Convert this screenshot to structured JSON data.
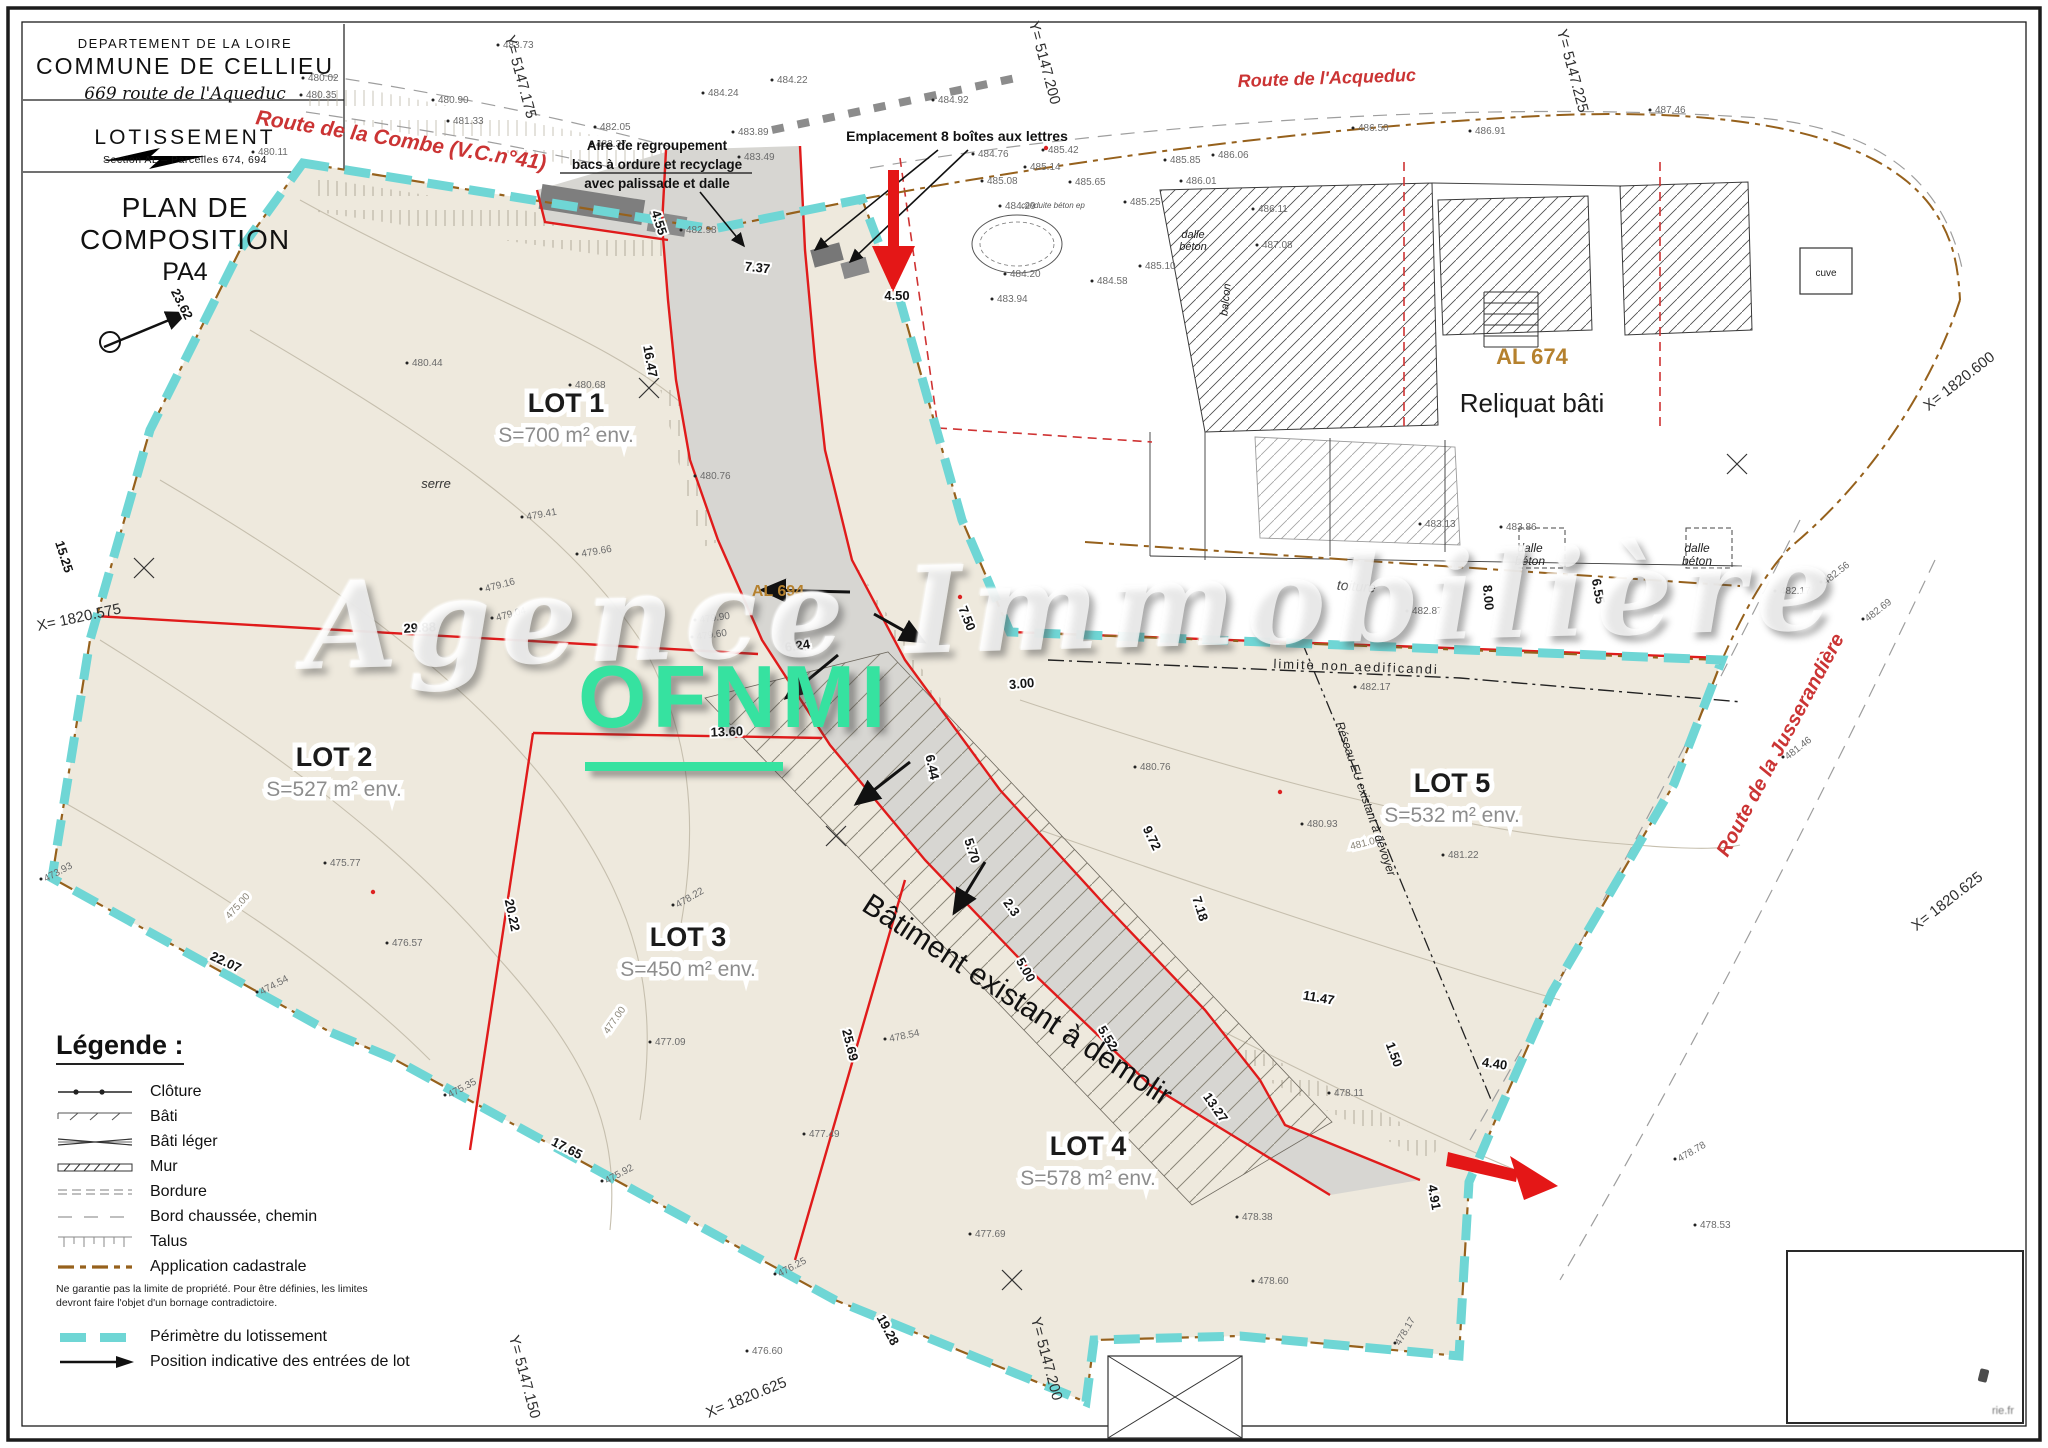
{
  "title_block": {
    "department": "DEPARTEMENT DE LA LOIRE",
    "commune": "COMMUNE DE CELLIEU",
    "address": "669 route de l'Aqueduc",
    "doc_type": "LOTISSEMENT",
    "section": "Section AL – Parcelles 674, 694",
    "plan_title": "PLAN DE COMPOSITION",
    "plan_ref": "PA4"
  },
  "watermark": {
    "script": "Agence Immobilière",
    "brand": "OFNMI"
  },
  "stamp": {
    "text": "rie.fr"
  },
  "legend": {
    "title": "Légende :",
    "items": [
      {
        "key": "cloture",
        "label": "Clôture"
      },
      {
        "key": "bati",
        "label": "Bâti"
      },
      {
        "key": "bati-leger",
        "label": "Bâti léger"
      },
      {
        "key": "mur",
        "label": "Mur"
      },
      {
        "key": "bordure",
        "label": "Bordure"
      },
      {
        "key": "bord-chaussee",
        "label": "Bord chaussée, chemin"
      },
      {
        "key": "talus",
        "label": "Talus"
      },
      {
        "key": "application-cadastrale",
        "label": "Application cadastrale"
      }
    ],
    "cadastral_note_line1": "Ne garantie pas la limite de propriété. Pour être définies, les limites",
    "cadastral_note_line2": "devront faire l'objet d'un bornage contradictoire.",
    "perimeter_label": "Périmètre du lotissement",
    "entries_label": "Position indicative des entrées de lot"
  },
  "lots": [
    {
      "name": "LOT 1",
      "area": "S=700 m² env.",
      "x": 566,
      "y": 412
    },
    {
      "name": "LOT 2",
      "area": "S=527 m² env.",
      "x": 334,
      "y": 766
    },
    {
      "name": "LOT 3",
      "area": "S=450 m² env.",
      "x": 688,
      "y": 946
    },
    {
      "name": "LOT 4",
      "area": "S=578 m² env.",
      "x": 1088,
      "y": 1155
    },
    {
      "name": "LOT 5",
      "area": "S=532 m² env.",
      "x": 1452,
      "y": 792
    }
  ],
  "map": {
    "roads": [
      {
        "t": "Route de la Combe (V.C.n°41)",
        "x": 400,
        "y": 147,
        "r": 9,
        "s": 21,
        "n": "road-label-combe"
      },
      {
        "t": "Route de l'Acqueduc",
        "x": 1327,
        "y": 84,
        "r": -2,
        "s": 18,
        "n": "road-label-acqueduc"
      },
      {
        "t": "Route de la Jusserandière",
        "x": 1786,
        "y": 748,
        "r": -62,
        "s": 20,
        "n": "road-label-jusserandiere"
      }
    ],
    "texts": [
      {
        "t": "AL 674",
        "x": 1532,
        "y": 364,
        "s": 22,
        "c": "#b5812e",
        "w": 700,
        "n": "parcel-code-al674"
      },
      {
        "t": "Reliquat bâti",
        "x": 1532,
        "y": 412,
        "s": 26,
        "c": "#1a1a1a",
        "n": "reliquat-bati-label"
      },
      {
        "t": "AL 694",
        "x": 778,
        "y": 596,
        "s": 16,
        "c": "#b5812e",
        "w": 700,
        "n": "parcel-code-al694"
      },
      {
        "t": "Bâtiment existant à démolir",
        "x": 1012,
        "y": 1008,
        "s": 30,
        "r": 33,
        "c": "#111111",
        "n": "batiment-demolir-label"
      },
      {
        "t": "serre",
        "x": 436,
        "y": 488,
        "s": 13,
        "i": 1,
        "c": "#333333",
        "n": "serre-label"
      },
      {
        "t": "toiture",
        "x": 1356,
        "y": 591,
        "s": 14,
        "i": 1,
        "r": 4,
        "c": "#444444",
        "n": "toiture-label"
      },
      {
        "t": "limite non aedificandi",
        "x": 1356,
        "y": 671,
        "s": 13,
        "r": 2,
        "sp": 2,
        "c": "#222222",
        "n": "limite-non-aedificandi-label"
      },
      {
        "t": "Réseau EU existant à dévoyer",
        "x": 1362,
        "y": 800,
        "s": 12,
        "r": 71,
        "i": 1,
        "c": "#222222",
        "n": "reseau-eu-label"
      },
      {
        "t": "dalle",
        "x": 1193,
        "y": 238,
        "s": 11,
        "i": 1,
        "c": "#222222",
        "n": "dalle-beton-label"
      },
      {
        "t": "béton",
        "x": 1193,
        "y": 250,
        "s": 11,
        "i": 1,
        "c": "#222222",
        "n": "dalle-beton-label"
      },
      {
        "t": "dalle",
        "x": 1530,
        "y": 552,
        "s": 12,
        "i": 1,
        "c": "#222222",
        "n": "dalle-beton-label"
      },
      {
        "t": "béton",
        "x": 1530,
        "y": 565,
        "s": 12,
        "i": 1,
        "c": "#222222",
        "n": "dalle-beton-label"
      },
      {
        "t": "dalle",
        "x": 1697,
        "y": 552,
        "s": 12,
        "i": 1,
        "c": "#222222",
        "n": "dalle-beton-label"
      },
      {
        "t": "béton",
        "x": 1697,
        "y": 565,
        "s": 12,
        "i": 1,
        "c": "#222222",
        "n": "dalle-beton-label"
      },
      {
        "t": "balcon",
        "x": 1229,
        "y": 300,
        "r": -84,
        "s": 11,
        "i": 1,
        "c": "#222222",
        "n": "balcon-label"
      },
      {
        "t": "conduite béton ep",
        "x": 1053,
        "y": 208,
        "s": 8,
        "i": 1,
        "c": "#555555",
        "n": "conduite-beton-label"
      },
      {
        "t": "cuve",
        "x": 1826,
        "y": 276,
        "s": 10,
        "c": "#222222",
        "n": "cuve-label"
      },
      {
        "t": "Aire de regroupement",
        "x": 657,
        "y": 150,
        "s": 13.5,
        "w": 700,
        "c": "#111111",
        "n": "callout-aire-line1"
      },
      {
        "t": "bacs à ordure et recyclage",
        "x": 657,
        "y": 169,
        "s": 13.5,
        "w": 700,
        "c": "#111111",
        "n": "callout-aire-line2"
      },
      {
        "t": "avec palissade et dalle",
        "x": 657,
        "y": 188,
        "s": 13.5,
        "w": 700,
        "c": "#111111",
        "n": "callout-aire-line3"
      },
      {
        "t": "Emplacement 8 boîtes aux lettres",
        "x": 957,
        "y": 141,
        "s": 14,
        "w": 700,
        "c": "#111111",
        "n": "callout-mailboxes"
      }
    ],
    "dimensions": [
      {
        "v": "7.37",
        "x": 757,
        "y": 272,
        "r": 6
      },
      {
        "v": "4.55",
        "x": 655,
        "y": 224,
        "r": 72
      },
      {
        "v": "4.50",
        "x": 897,
        "y": 300,
        "r": 0
      },
      {
        "v": "16.47",
        "x": 646,
        "y": 362,
        "r": 80
      },
      {
        "v": "29.88",
        "x": 420,
        "y": 632,
        "r": -3
      },
      {
        "v": "13.60",
        "x": 727,
        "y": 736,
        "r": -2
      },
      {
        "v": "23.62",
        "x": 178,
        "y": 306,
        "r": 63
      },
      {
        "v": "15.25",
        "x": 60,
        "y": 558,
        "r": 72
      },
      {
        "v": "20.22",
        "x": 508,
        "y": 916,
        "r": 78
      },
      {
        "v": "22.07",
        "x": 224,
        "y": 966,
        "r": 25
      },
      {
        "v": "17.65",
        "x": 565,
        "y": 1152,
        "r": 27
      },
      {
        "v": "25.69",
        "x": 846,
        "y": 1046,
        "r": 76
      },
      {
        "v": "19.28",
        "x": 884,
        "y": 1332,
        "r": 62
      },
      {
        "v": "7.50",
        "x": 963,
        "y": 620,
        "r": 68
      },
      {
        "v": "3.00",
        "x": 1022,
        "y": 688,
        "r": -5
      },
      {
        "v": "9.72",
        "x": 1148,
        "y": 840,
        "r": 64
      },
      {
        "v": "6.44",
        "x": 928,
        "y": 768,
        "r": 78
      },
      {
        "v": "5.70",
        "x": 968,
        "y": 852,
        "r": 72
      },
      {
        "v": "5.52",
        "x": 1104,
        "y": 1040,
        "r": 58
      },
      {
        "v": "7.18",
        "x": 1196,
        "y": 910,
        "r": 72
      },
      {
        "v": "11.47",
        "x": 1318,
        "y": 1002,
        "r": 10
      },
      {
        "v": "13.27",
        "x": 1212,
        "y": 1110,
        "r": 55
      },
      {
        "v": "4.40",
        "x": 1494,
        "y": 1068,
        "r": 8
      },
      {
        "v": "4.91",
        "x": 1430,
        "y": 1198,
        "r": 80
      },
      {
        "v": "1.50",
        "x": 1390,
        "y": 1056,
        "r": 70
      },
      {
        "v": "8.00",
        "x": 1484,
        "y": 598,
        "r": 85
      },
      {
        "v": "6.55",
        "x": 1594,
        "y": 592,
        "r": 80
      },
      {
        "v": "6.24",
        "x": 798,
        "y": 650,
        "r": -8
      },
      {
        "v": "2.3",
        "x": 1008,
        "y": 910,
        "r": 55
      },
      {
        "v": "5.00",
        "x": 1022,
        "y": 972,
        "r": 60
      }
    ],
    "coordinate_labels": [
      {
        "v": "Y= 5147.175",
        "x": 516,
        "y": 78,
        "r": 75
      },
      {
        "v": "Y= 5147.200",
        "x": 1040,
        "y": 64,
        "r": 75
      },
      {
        "v": "Y= 5147.225",
        "x": 1568,
        "y": 72,
        "r": 75
      },
      {
        "v": "X= 1820.600",
        "x": 1962,
        "y": 385,
        "r": -38
      },
      {
        "v": "X= 1820.625",
        "x": 1950,
        "y": 905,
        "r": -38
      },
      {
        "v": "X= 1820.575",
        "x": 80,
        "y": 622,
        "r": -12
      },
      {
        "v": "Y= 5147.150",
        "x": 520,
        "y": 1378,
        "r": 75
      },
      {
        "v": "X= 1820.625",
        "x": 748,
        "y": 1402,
        "r": -22
      },
      {
        "v": "Y= 5147.200",
        "x": 1042,
        "y": 1360,
        "r": 75
      }
    ],
    "contour_labels": [
      {
        "v": "475.00",
        "x": 240,
        "y": 908,
        "r": -48
      },
      {
        "v": "477.00",
        "x": 617,
        "y": 1022,
        "r": -55
      },
      {
        "v": "481.00",
        "x": 1366,
        "y": 846,
        "r": -14
      }
    ],
    "spot_elevations": [
      {
        "v": "480.02",
        "x": 308,
        "y": 81
      },
      {
        "v": "480.35",
        "x": 306,
        "y": 98
      },
      {
        "v": "480.11",
        "x": 258,
        "y": 155
      },
      {
        "v": "483.73",
        "x": 503,
        "y": 48
      },
      {
        "v": "484.22",
        "x": 777,
        "y": 83
      },
      {
        "v": "484.24",
        "x": 708,
        "y": 96
      },
      {
        "v": "483.89",
        "x": 738,
        "y": 135
      },
      {
        "v": "483.49",
        "x": 744,
        "y": 160
      },
      {
        "v": "484.92",
        "x": 938,
        "y": 103
      },
      {
        "v": "485.42",
        "x": 1048,
        "y": 153
      },
      {
        "v": "484.76",
        "x": 978,
        "y": 157
      },
      {
        "v": "485.14",
        "x": 1030,
        "y": 170
      },
      {
        "v": "485.08",
        "x": 987,
        "y": 184
      },
      {
        "v": "485.65",
        "x": 1075,
        "y": 185
      },
      {
        "v": "485.85",
        "x": 1170,
        "y": 163
      },
      {
        "v": "486.01",
        "x": 1186,
        "y": 184
      },
      {
        "v": "486.06",
        "x": 1218,
        "y": 158
      },
      {
        "v": "484.29",
        "x": 1005,
        "y": 209
      },
      {
        "v": "485.25",
        "x": 1130,
        "y": 205
      },
      {
        "v": "486.11",
        "x": 1258,
        "y": 212
      },
      {
        "v": "486.50",
        "x": 1358,
        "y": 131
      },
      {
        "v": "486.91",
        "x": 1475,
        "y": 134
      },
      {
        "v": "487.46",
        "x": 1655,
        "y": 113
      },
      {
        "v": "484.20",
        "x": 1010,
        "y": 277
      },
      {
        "v": "484.58",
        "x": 1097,
        "y": 284
      },
      {
        "v": "485.10",
        "x": 1145,
        "y": 269
      },
      {
        "v": "483.94",
        "x": 997,
        "y": 302
      },
      {
        "v": "487.08",
        "x": 1262,
        "y": 248
      },
      {
        "v": "481.33",
        "x": 453,
        "y": 124
      },
      {
        "v": "482.05",
        "x": 600,
        "y": 130
      },
      {
        "v": "482.37",
        "x": 596,
        "y": 147
      },
      {
        "v": "480.90",
        "x": 438,
        "y": 103
      },
      {
        "v": "482.98",
        "x": 686,
        "y": 233
      },
      {
        "v": "480.44",
        "x": 412,
        "y": 366
      },
      {
        "v": "480.68",
        "x": 575,
        "y": 388
      },
      {
        "v": "480.76",
        "x": 700,
        "y": 479
      },
      {
        "v": "479.41",
        "x": 527,
        "y": 520,
        "r": -10
      },
      {
        "v": "479.66",
        "x": 582,
        "y": 557,
        "r": -10
      },
      {
        "v": "479.16",
        "x": 486,
        "y": 592,
        "r": -15
      },
      {
        "v": "479.04",
        "x": 497,
        "y": 621,
        "r": -15
      },
      {
        "v": "479.90",
        "x": 700,
        "y": 623,
        "r": -8
      },
      {
        "v": "479.60",
        "x": 697,
        "y": 640,
        "r": -8
      },
      {
        "v": "480.76",
        "x": 1140,
        "y": 770
      },
      {
        "v": "480.93",
        "x": 1307,
        "y": 827
      },
      {
        "v": "481.22",
        "x": 1448,
        "y": 858
      },
      {
        "v": "482.17",
        "x": 1360,
        "y": 690
      },
      {
        "v": "482.87",
        "x": 1412,
        "y": 614
      },
      {
        "v": "483.13",
        "x": 1425,
        "y": 527
      },
      {
        "v": "483.86",
        "x": 1506,
        "y": 530
      },
      {
        "v": "482.56",
        "x": 1826,
        "y": 585,
        "r": -38
      },
      {
        "v": "482.69",
        "x": 1868,
        "y": 622,
        "r": -38
      },
      {
        "v": "482.17",
        "x": 1780,
        "y": 594
      },
      {
        "v": "481.46",
        "x": 1788,
        "y": 760,
        "r": -38
      },
      {
        "v": "478.22",
        "x": 678,
        "y": 908,
        "r": -30
      },
      {
        "v": "478.54",
        "x": 890,
        "y": 1042,
        "r": -12
      },
      {
        "v": "477.09",
        "x": 655,
        "y": 1045
      },
      {
        "v": "477.49",
        "x": 809,
        "y": 1137
      },
      {
        "v": "477.69",
        "x": 975,
        "y": 1237
      },
      {
        "v": "475.77",
        "x": 330,
        "y": 866
      },
      {
        "v": "473.93",
        "x": 46,
        "y": 882,
        "r": -28
      },
      {
        "v": "474.54",
        "x": 262,
        "y": 995,
        "r": -28
      },
      {
        "v": "475.35",
        "x": 450,
        "y": 1098,
        "r": -28
      },
      {
        "v": "475.92",
        "x": 607,
        "y": 1184,
        "r": -28
      },
      {
        "v": "476.25",
        "x": 780,
        "y": 1277,
        "r": -28
      },
      {
        "v": "476.57",
        "x": 392,
        "y": 946
      },
      {
        "v": "478.11",
        "x": 1334,
        "y": 1096
      },
      {
        "v": "478.78",
        "x": 1680,
        "y": 1162,
        "r": -30
      },
      {
        "v": "478.53",
        "x": 1700,
        "y": 1228
      },
      {
        "v": "478.38",
        "x": 1242,
        "y": 1220
      },
      {
        "v": "478.60",
        "x": 1258,
        "y": 1284
      },
      {
        "v": "478.17",
        "x": 1400,
        "y": 1346,
        "r": -60
      },
      {
        "v": "476.60",
        "x": 752,
        "y": 1354
      }
    ]
  },
  "colors": {
    "beige": "#eee9dd",
    "road_gray": "#d7d6d2",
    "perimeter_cyan": "#6fd6d5",
    "boundary_red": "#e01b1b",
    "road_text_red": "#cb3434",
    "cadastral_brown": "#96611c",
    "parcel_orange": "#b5812e",
    "brand_green": "#36e2a0"
  }
}
